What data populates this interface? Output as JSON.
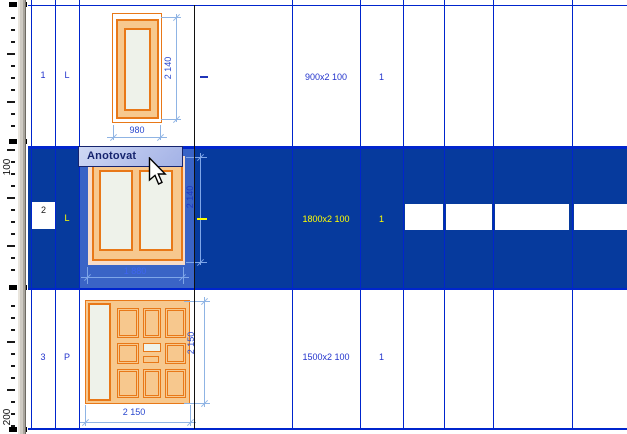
{
  "tooltip": {
    "label": "Anotovat"
  },
  "ruler": {
    "label_100": "100",
    "label_200": "200"
  },
  "table": {
    "rows": [
      {
        "id": "1",
        "hinge": "L",
        "size": "900x2 100",
        "qty": "1",
        "dim_w": "980",
        "dim_h": "2 140"
      },
      {
        "id": "2",
        "hinge": "L",
        "size": "1800x2 100",
        "qty": "1",
        "dim_w": "1 880",
        "dim_h": "2 140"
      },
      {
        "id": "3",
        "hinge": "P",
        "size": "1500x2 100",
        "qty": "1",
        "dim_w": "2 150",
        "dim_h": "2 150"
      }
    ]
  },
  "colors": {
    "selection_blue": "#063a9d",
    "cell_highlight_blue": "#3a64c6",
    "grid_blue": "#0025cd",
    "frame_orange": "#e87818",
    "frame_fill_orange": "#f7c88e",
    "glass_fill": "#eef2ea",
    "dim_text_blue": "#2947ce",
    "dim_line_blue": "#8fb4e4",
    "selected_text_yellow": "#ffff00"
  }
}
